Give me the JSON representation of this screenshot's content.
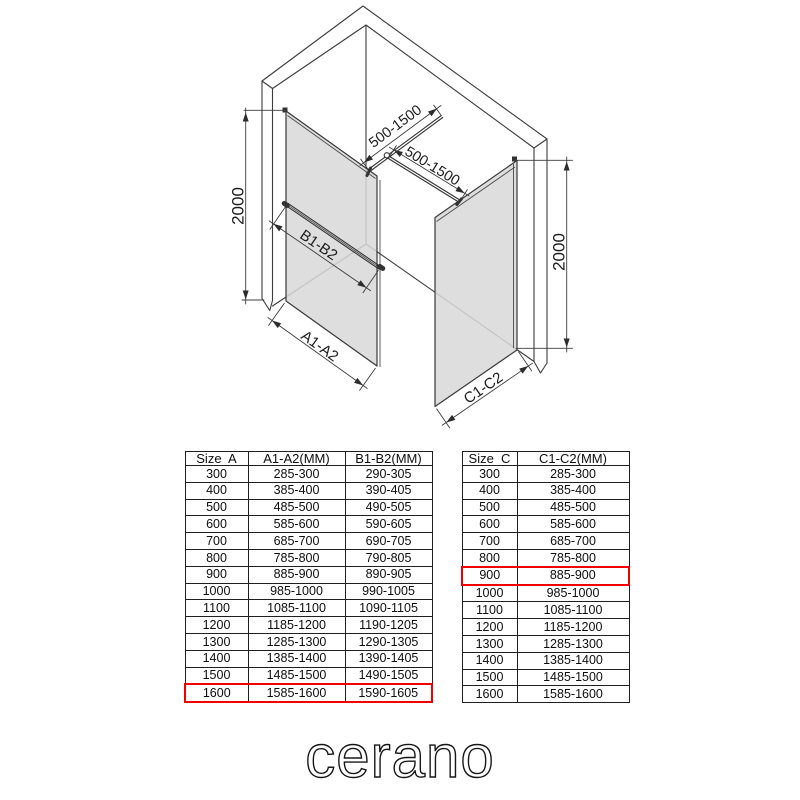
{
  "brand": {
    "logo_text": "cerano"
  },
  "diagram": {
    "labels": {
      "height_left": "2000",
      "height_right": "2000",
      "brace_bar_left": "500-1500",
      "brace_bar_right": "500-1500",
      "support_bar": "B1-B2",
      "panel_a_width": "A1-A2",
      "panel_c_width": "C1-C2"
    },
    "colors": {
      "line": "#3c3c3c",
      "glass": "#d8d8d8",
      "highlight": "#f20000"
    }
  },
  "tables": {
    "left": {
      "headers": [
        "Size  A",
        "A1-A2(MM)",
        "B1-B2(MM)"
      ],
      "rows": [
        [
          "300",
          "285-300",
          "290-305"
        ],
        [
          "400",
          "385-400",
          "390-405"
        ],
        [
          "500",
          "485-500",
          "490-505"
        ],
        [
          "600",
          "585-600",
          "590-605"
        ],
        [
          "700",
          "685-700",
          "690-705"
        ],
        [
          "800",
          "785-800",
          "790-805"
        ],
        [
          "900",
          "885-900",
          "890-905"
        ],
        [
          "1000",
          "985-1000",
          "990-1005"
        ],
        [
          "1100",
          "1085-1100",
          "1090-1105"
        ],
        [
          "1200",
          "1185-1200",
          "1190-1205"
        ],
        [
          "1300",
          "1285-1300",
          "1290-1305"
        ],
        [
          "1400",
          "1385-1400",
          "1390-1405"
        ],
        [
          "1500",
          "1485-1500",
          "1490-1505"
        ],
        [
          "1600",
          "1585-1600",
          "1590-1605"
        ]
      ],
      "highlight_row_index": 13
    },
    "right": {
      "headers": [
        "Size  C",
        "C1-C2(MM)"
      ],
      "rows": [
        [
          "300",
          "285-300"
        ],
        [
          "400",
          "385-400"
        ],
        [
          "500",
          "485-500"
        ],
        [
          "600",
          "585-600"
        ],
        [
          "700",
          "685-700"
        ],
        [
          "800",
          "785-800"
        ],
        [
          "900",
          "885-900"
        ],
        [
          "1000",
          "985-1000"
        ],
        [
          "1100",
          "1085-1100"
        ],
        [
          "1200",
          "1185-1200"
        ],
        [
          "1300",
          "1285-1300"
        ],
        [
          "1400",
          "1385-1400"
        ],
        [
          "1500",
          "1485-1500"
        ],
        [
          "1600",
          "1585-1600"
        ]
      ],
      "highlight_row_index": 6
    }
  }
}
